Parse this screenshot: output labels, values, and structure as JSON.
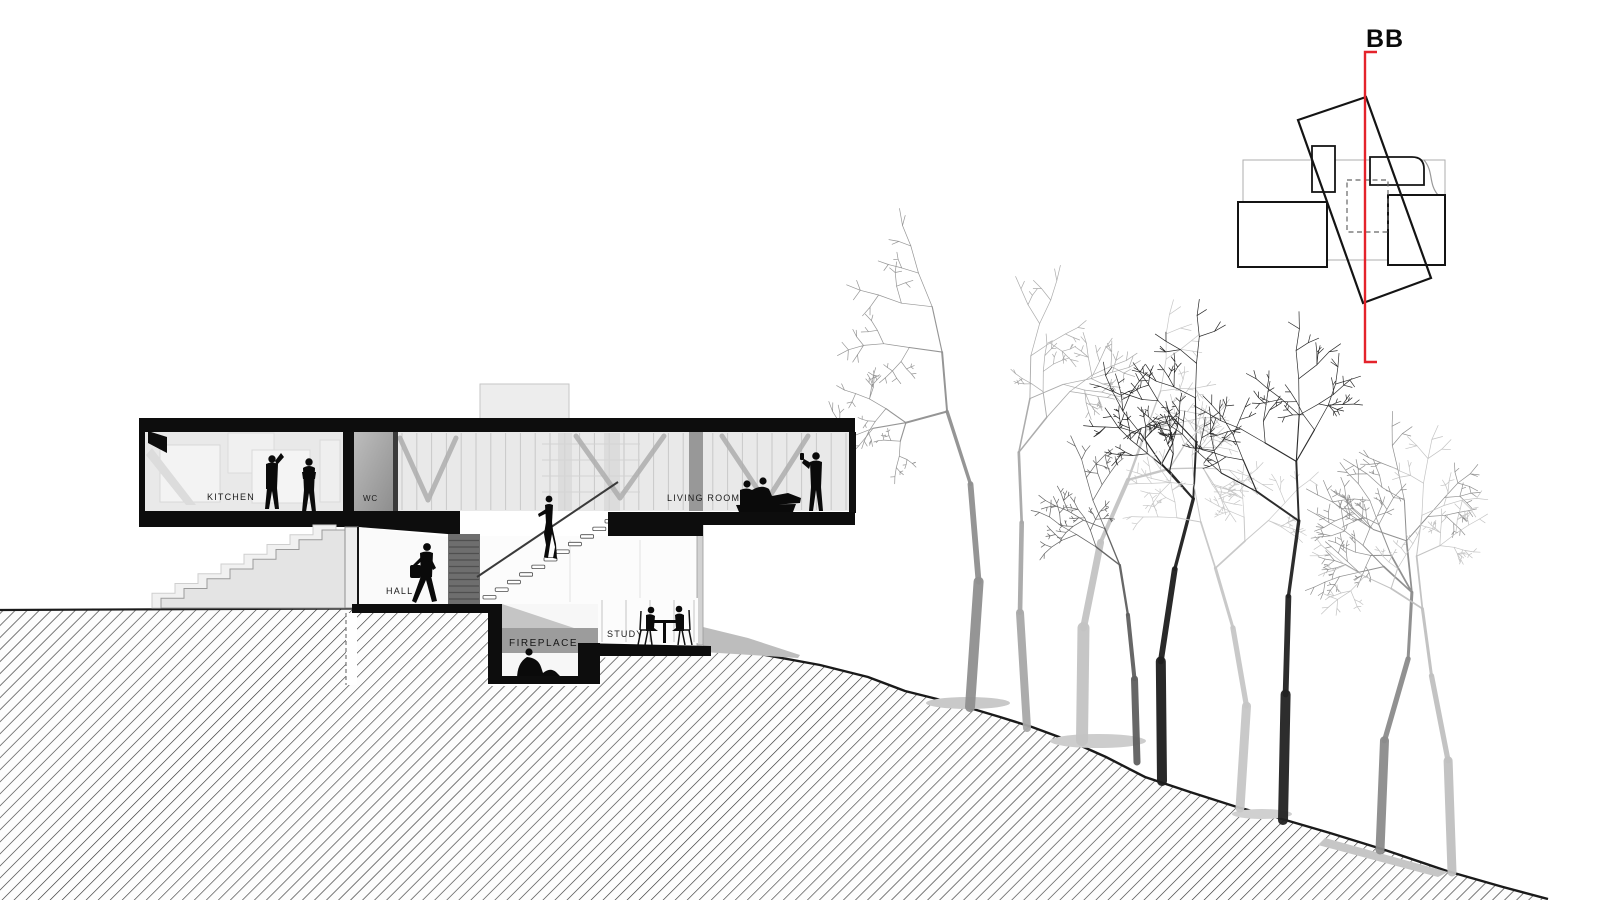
{
  "keyplan": {
    "label": "BB"
  },
  "rooms": {
    "kitchen": "KITCHEN",
    "wc": "WC",
    "hall": "HALL",
    "living_room": "LIVING ROOM",
    "fireplace": "FIREPLACE",
    "study": "STUDY"
  },
  "colors": {
    "section_line_red": "#e4232b",
    "slab_black": "#0d0d0d",
    "interior_gray": "#e9e9e9",
    "wc_gray": "#a2a2a2",
    "fireplace_band_gray": "#9c9c9c",
    "louver_gray": "#6e6e6e",
    "hatch_line": "#333333",
    "terrain_line": "#1a1a1a",
    "figure_black": "#0a0a0a",
    "tree_dark": "#1e1e1e",
    "tree_mid": "#8f8f8f",
    "tree_light": "#c4c4c4"
  },
  "trees": [
    {
      "name": "tree-gray-tall",
      "x": 970,
      "base": 707,
      "top": 242,
      "color": "#8f8f8f",
      "w": 10,
      "seed": 11,
      "droop": 0.55
    },
    {
      "name": "tree-gray-mid",
      "x": 1027,
      "base": 728,
      "top": 300,
      "color": "#a8a8a8",
      "w": 8,
      "seed": 23,
      "droop": 0.15
    },
    {
      "name": "tree-lightgray-big",
      "x": 1082,
      "base": 740,
      "top": 325,
      "color": "#c3c3c3",
      "w": 12,
      "seed": 37,
      "droop": 0.35
    },
    {
      "name": "tree-darkgray-small",
      "x": 1137,
      "base": 762,
      "top": 455,
      "color": "#5f5f5f",
      "w": 7,
      "seed": 41,
      "droop": 0.25
    },
    {
      "name": "tree-black-tall",
      "x": 1162,
      "base": 781,
      "top": 338,
      "color": "#1e1e1e",
      "w": 10,
      "seed": 53,
      "droop": 0.2
    },
    {
      "name": "tree-lightgray",
      "x": 1240,
      "base": 808,
      "top": 430,
      "color": "#c6c6c6",
      "w": 9,
      "seed": 67,
      "droop": 0.3
    },
    {
      "name": "tree-black",
      "x": 1283,
      "base": 820,
      "top": 355,
      "color": "#222222",
      "w": 10,
      "seed": 71,
      "droop": 0.15
    },
    {
      "name": "tree-gray-right",
      "x": 1380,
      "base": 850,
      "top": 445,
      "color": "#8b8b8b",
      "w": 9,
      "seed": 83,
      "droop": 0.25
    },
    {
      "name": "tree-lightgray-right",
      "x": 1452,
      "base": 872,
      "top": 460,
      "color": "#c0c0c0",
      "w": 9,
      "seed": 97,
      "droop": 0.35
    }
  ]
}
